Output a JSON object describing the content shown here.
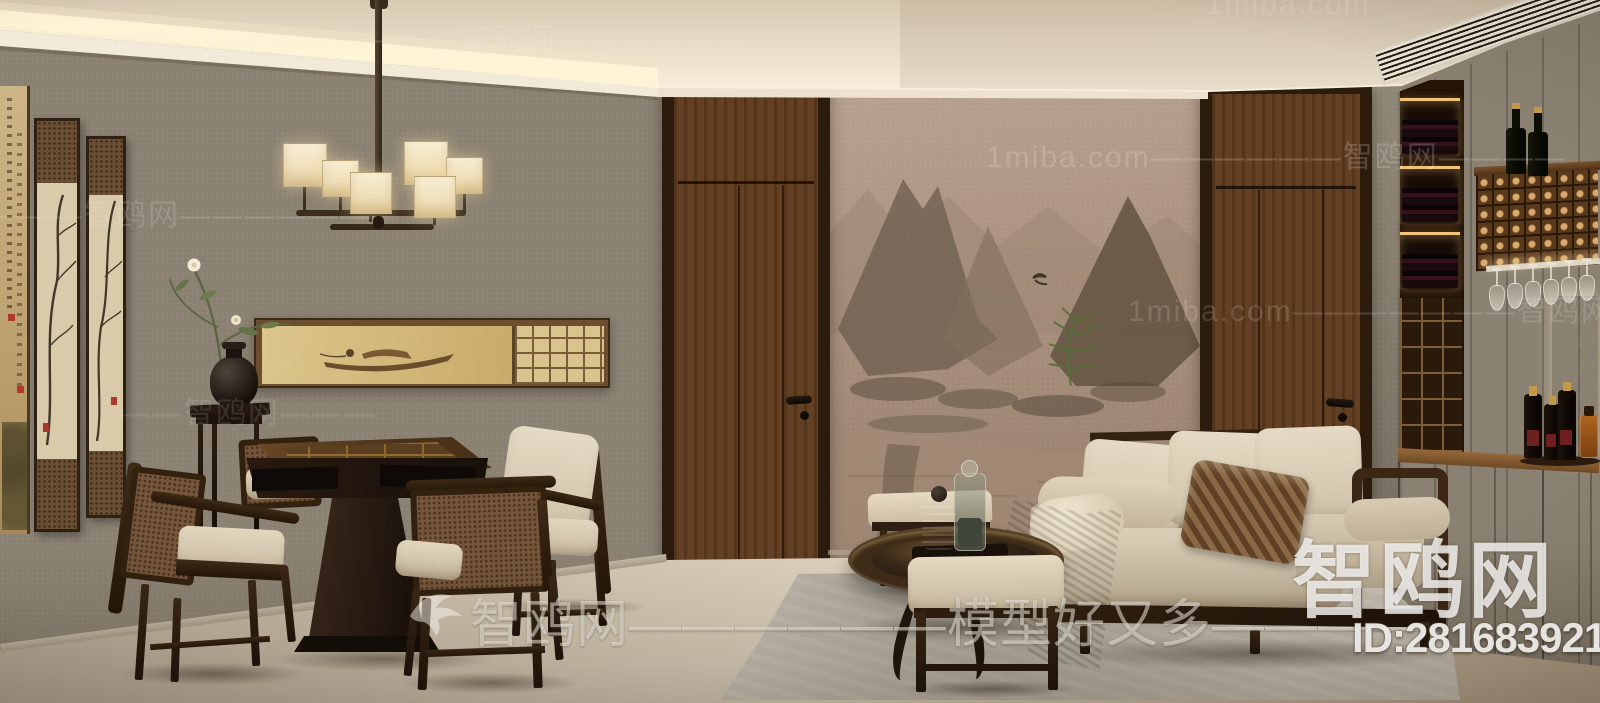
{
  "watermarks": {
    "rows": [
      {
        "text": "1miba.com——————智鸥网——————"
      },
      {
        "text": "1miba.com——————智鸥网————"
      },
      {
        "text": "———智鸥网——————"
      },
      {
        "text": "1miba.com———————智鸥网———"
      },
      {
        "text": "——智鸥网———"
      },
      {
        "text": "1miba.com"
      }
    ],
    "bottom_brand_text": "智鸥网——————模型好又多————",
    "corner_brand_text": "智鸥网",
    "corner_id_text": "ID:281683921"
  },
  "icons": {
    "watermark_bird": "bird-logo"
  },
  "palette": {
    "ceiling_cream": "#f2e9d6",
    "cove_glow": "#fff3d4",
    "wall_taupe": "#948a7a",
    "mural_rose_tan": "#a98f7c",
    "door_walnut": "#6b4423",
    "wood_dark": "#2e1d10",
    "cabinet_walnut": "#5a3a1e",
    "sofa_beige": "#d8ccb4",
    "throw_brown": "#8a6a4e",
    "floor_beige": "#cfc3ae",
    "led_warm": "#f3c37c",
    "plant_green": "#5f7a40",
    "seal_red": "#b03a2a"
  }
}
